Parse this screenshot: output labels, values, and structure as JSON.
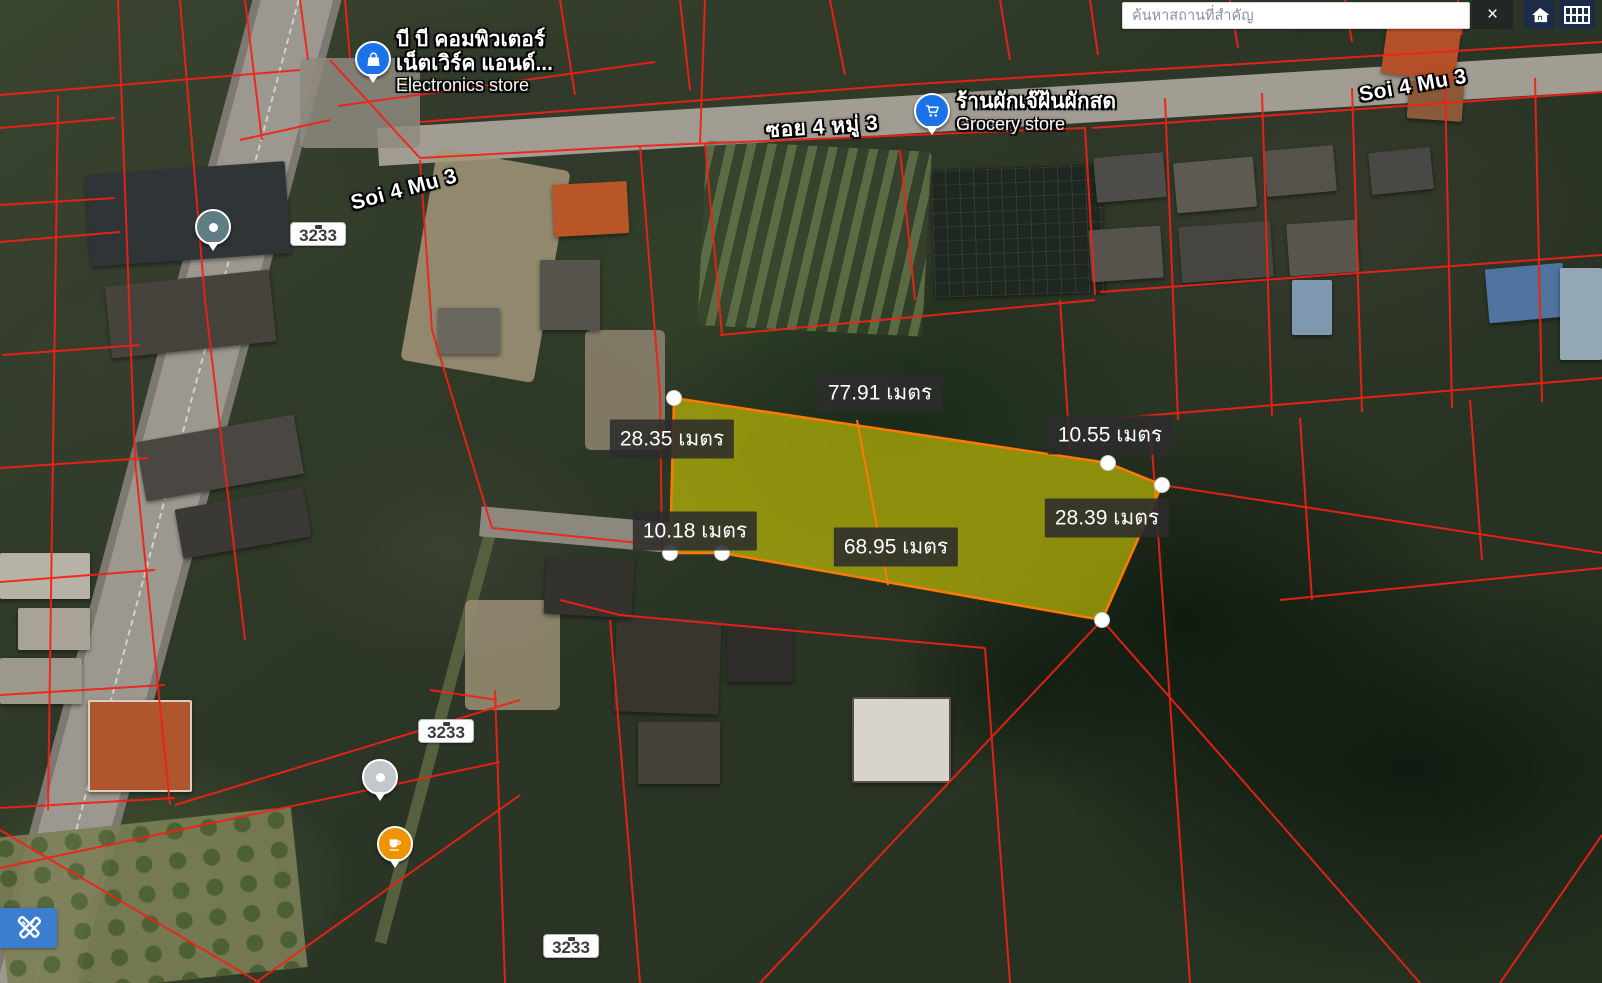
{
  "search": {
    "placeholder": "ค้นหาสถานที่สำคัญ",
    "close_label": "×"
  },
  "toolbar_icons": [
    {
      "name": "close-icon"
    },
    {
      "name": "home-icon"
    },
    {
      "name": "grid-icon"
    },
    {
      "name": "measure-tool-icon"
    }
  ],
  "colors": {
    "poi_blue": "#1a73e8",
    "cafe_orange": "#ef9300",
    "farm_teal": "#5f7d82",
    "closed_gray": "#c3c8cd",
    "parcel_fill": "#e8e000",
    "parcel_stroke": "#ff7a00",
    "cadastral_red": "#f32015",
    "button_navy": "#1c2b47",
    "tool_blue": "#3b7ed0"
  },
  "map": {
    "road_labels": [
      {
        "text": "Soi 4 Mu 3",
        "x": 404,
        "y": 190,
        "rotate": -15
      },
      {
        "text": "ซอย 4 หมู่ 3",
        "x": 822,
        "y": 127,
        "rotate": -4
      },
      {
        "text": "Soi 4 Mu 3",
        "x": 1413,
        "y": 86,
        "rotate": -10
      }
    ],
    "route_shields": [
      {
        "number": "3233",
        "x": 318,
        "y": 234
      },
      {
        "number": "3233",
        "x": 446,
        "y": 731
      },
      {
        "number": "3233",
        "x": 571,
        "y": 946
      }
    ],
    "pois": [
      {
        "id": "electronics-store",
        "icon": "shopping-bag",
        "icon_color": "#1a73e8",
        "icon_x": 371,
        "icon_y": 57,
        "text_side": "right",
        "text_x": 396,
        "text_y": 28,
        "name_lines": [
          "บี บี คอมพิวเตอร์",
          "เน็ตเวิร์ค แอนด์..."
        ],
        "category": "Electronics store"
      },
      {
        "id": "grocery-store",
        "icon": "shopping-cart",
        "icon_color": "#1a73e8",
        "icon_x": 930,
        "icon_y": 109,
        "text_side": "right",
        "text_x": 956,
        "text_y": 90,
        "name_lines": [
          "ร้านผักเจ๊ฝ้นผักสด"
        ],
        "category": "Grocery store"
      },
      {
        "id": "farm",
        "icon": "generic-pin",
        "icon_color": "#5f7d82",
        "icon_x": 211,
        "icon_y": 225,
        "text_side": "left",
        "text_x": 196,
        "text_y": 200,
        "name_lines": [
          "สุภิรมย์ฟาร์ม"
        ],
        "category": "Farm"
      },
      {
        "id": "taxi-service",
        "icon": "closed-pin",
        "icon_color": "#c3c8cd",
        "icon_x": 378,
        "icon_y": 775,
        "text_side": "left",
        "text_x": 355,
        "text_y": 737,
        "name_lines": [
          "บริการ แท็กซี่ 5",
          "ที่นั่ง 7ที่นั่ง..."
        ],
        "category": "Temporarily closed"
      },
      {
        "id": "banluang-cafe",
        "icon": "cafe",
        "icon_color": "#ef9300",
        "icon_x": 393,
        "icon_y": 842,
        "text_side": "left",
        "text_x": 372,
        "text_y": 817,
        "name_lines": [
          "Banluang Cafe",
          "(กาแฟสดบ้านหลวง)"
        ],
        "category": ""
      }
    ],
    "measurements": [
      {
        "text": "77.91 เมตร",
        "x": 880,
        "y": 393
      },
      {
        "text": "28.35 เมตร",
        "x": 672,
        "y": 439
      },
      {
        "text": "10.55 เมตร",
        "x": 1110,
        "y": 435
      },
      {
        "text": "10.18 เมตร",
        "x": 695,
        "y": 531
      },
      {
        "text": "28.39 เมตร",
        "x": 1107,
        "y": 518
      },
      {
        "text": "68.95 เมตร",
        "x": 896,
        "y": 547
      }
    ],
    "parcel": {
      "vertices": [
        [
          674,
          398
        ],
        [
          1108,
          463
        ],
        [
          1162,
          485
        ],
        [
          1102,
          620
        ],
        [
          722,
          553
        ],
        [
          670,
          553
        ]
      ],
      "divider": [
        [
          857,
          420
        ],
        [
          888,
          585
        ]
      ],
      "side_lengths_m": {
        "top": 77.91,
        "left": 28.35,
        "right_upper": 10.55,
        "right_lower": 28.39,
        "bottom": 68.95,
        "bottom_left": 10.18
      },
      "unit": "เมตร"
    }
  }
}
